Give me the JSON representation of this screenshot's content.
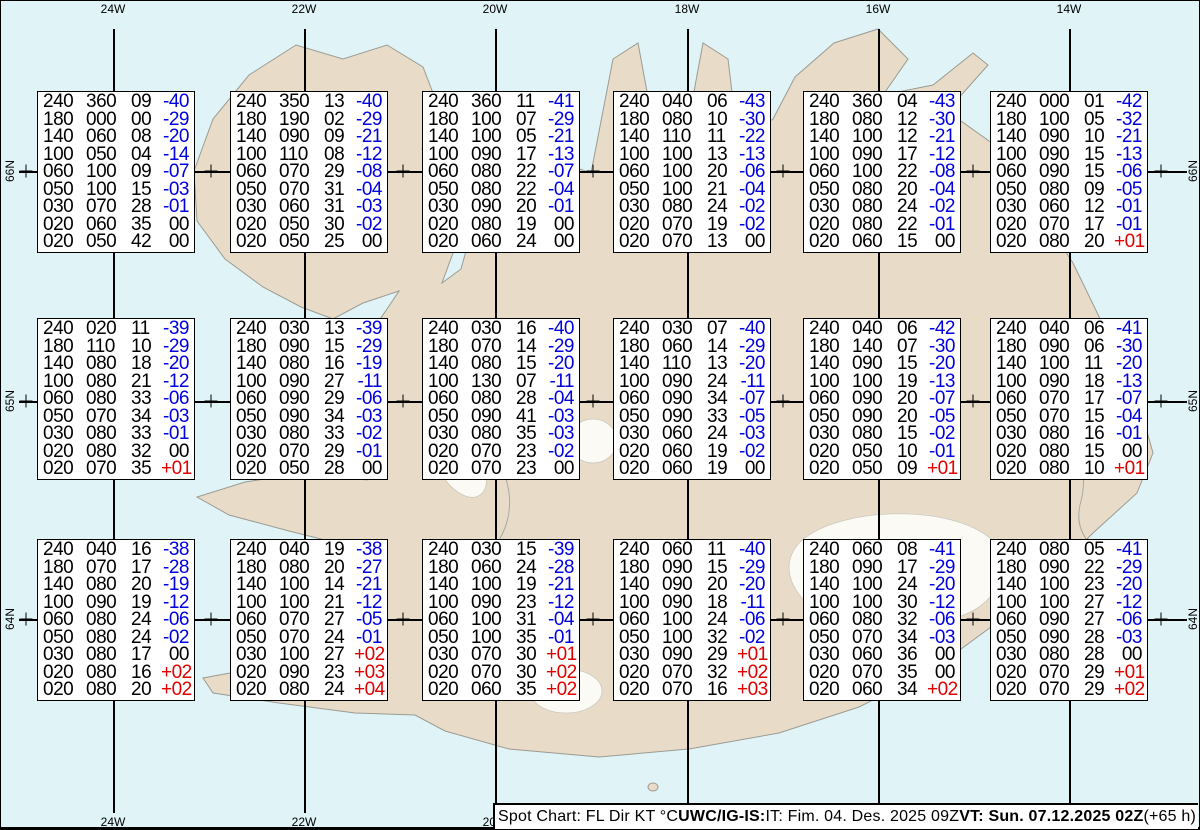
{
  "grid": {
    "meridian_labels": [
      "24W",
      "22W",
      "20W",
      "18W",
      "16W",
      "14W"
    ],
    "parallel_labels": [
      "66N",
      "65N",
      "64N"
    ]
  },
  "footer": {
    "segments": [
      {
        "text": "Spot Chart: FL Dir KT °C ",
        "bold": false
      },
      {
        "text": "UWC/IG-IS:",
        "bold": true
      },
      {
        "text": " IT: Fim. 04. Des. 2025 09Z ",
        "bold": false
      },
      {
        "text": "VT: Sun. 07.12.2025 02Z",
        "bold": true
      },
      {
        "text": " (+65 h)",
        "bold": false
      }
    ]
  },
  "colors": {
    "temp_negative": "#0000e0",
    "temp_positive": "#e00000",
    "temp_zero": "#000000",
    "values": "#000000",
    "ocean": "#e0f4f8",
    "land": "#e8dcc8"
  },
  "boxes": [
    {
      "rows": [
        [
          "240",
          "360",
          "09",
          "-40"
        ],
        [
          "180",
          "000",
          "00",
          "-29"
        ],
        [
          "140",
          "060",
          "08",
          "-20"
        ],
        [
          "100",
          "050",
          "04",
          "-14"
        ],
        [
          "060",
          "100",
          "09",
          "-07"
        ],
        [
          "050",
          "100",
          "15",
          "-03"
        ],
        [
          "030",
          "070",
          "28",
          "-01"
        ],
        [
          "020",
          "060",
          "35",
          "00"
        ],
        [
          "020",
          "050",
          "42",
          "00"
        ]
      ]
    },
    {
      "rows": [
        [
          "240",
          "350",
          "13",
          "-40"
        ],
        [
          "180",
          "190",
          "02",
          "-29"
        ],
        [
          "140",
          "090",
          "09",
          "-21"
        ],
        [
          "100",
          "110",
          "08",
          "-12"
        ],
        [
          "060",
          "070",
          "29",
          "-08"
        ],
        [
          "050",
          "070",
          "31",
          "-04"
        ],
        [
          "030",
          "060",
          "31",
          "-03"
        ],
        [
          "020",
          "050",
          "30",
          "-02"
        ],
        [
          "020",
          "050",
          "25",
          "00"
        ]
      ]
    },
    {
      "rows": [
        [
          "240",
          "360",
          "11",
          "-41"
        ],
        [
          "180",
          "100",
          "07",
          "-29"
        ],
        [
          "140",
          "100",
          "05",
          "-21"
        ],
        [
          "100",
          "090",
          "17",
          "-13"
        ],
        [
          "060",
          "080",
          "22",
          "-07"
        ],
        [
          "050",
          "080",
          "22",
          "-04"
        ],
        [
          "030",
          "090",
          "20",
          "-01"
        ],
        [
          "020",
          "080",
          "19",
          "00"
        ],
        [
          "020",
          "060",
          "24",
          "00"
        ]
      ]
    },
    {
      "rows": [
        [
          "240",
          "040",
          "06",
          "-43"
        ],
        [
          "180",
          "080",
          "10",
          "-30"
        ],
        [
          "140",
          "110",
          "11",
          "-22"
        ],
        [
          "100",
          "100",
          "13",
          "-13"
        ],
        [
          "060",
          "100",
          "20",
          "-06"
        ],
        [
          "050",
          "100",
          "21",
          "-04"
        ],
        [
          "030",
          "080",
          "24",
          "-02"
        ],
        [
          "020",
          "070",
          "19",
          "-02"
        ],
        [
          "020",
          "070",
          "13",
          "00"
        ]
      ]
    },
    {
      "rows": [
        [
          "240",
          "360",
          "04",
          "-43"
        ],
        [
          "180",
          "080",
          "12",
          "-30"
        ],
        [
          "140",
          "100",
          "12",
          "-21"
        ],
        [
          "100",
          "090",
          "17",
          "-12"
        ],
        [
          "060",
          "100",
          "22",
          "-08"
        ],
        [
          "050",
          "080",
          "20",
          "-04"
        ],
        [
          "030",
          "080",
          "24",
          "-02"
        ],
        [
          "020",
          "080",
          "22",
          "-01"
        ],
        [
          "020",
          "060",
          "15",
          "00"
        ]
      ]
    },
    {
      "rows": [
        [
          "240",
          "000",
          "01",
          "-42"
        ],
        [
          "180",
          "100",
          "05",
          "-32"
        ],
        [
          "140",
          "090",
          "10",
          "-21"
        ],
        [
          "100",
          "090",
          "15",
          "-13"
        ],
        [
          "060",
          "090",
          "15",
          "-06"
        ],
        [
          "050",
          "080",
          "09",
          "-05"
        ],
        [
          "030",
          "060",
          "12",
          "-01"
        ],
        [
          "020",
          "070",
          "17",
          "-01"
        ],
        [
          "020",
          "080",
          "20",
          "+01"
        ]
      ]
    },
    {
      "rows": [
        [
          "240",
          "020",
          "11",
          "-39"
        ],
        [
          "180",
          "110",
          "10",
          "-29"
        ],
        [
          "140",
          "080",
          "18",
          "-20"
        ],
        [
          "100",
          "080",
          "21",
          "-12"
        ],
        [
          "060",
          "080",
          "33",
          "-06"
        ],
        [
          "050",
          "070",
          "34",
          "-03"
        ],
        [
          "030",
          "080",
          "33",
          "-01"
        ],
        [
          "020",
          "080",
          "32",
          "00"
        ],
        [
          "020",
          "070",
          "35",
          "+01"
        ]
      ]
    },
    {
      "rows": [
        [
          "240",
          "030",
          "13",
          "-39"
        ],
        [
          "180",
          "090",
          "15",
          "-29"
        ],
        [
          "140",
          "080",
          "16",
          "-19"
        ],
        [
          "100",
          "090",
          "27",
          "-11"
        ],
        [
          "060",
          "090",
          "29",
          "-06"
        ],
        [
          "050",
          "090",
          "34",
          "-03"
        ],
        [
          "030",
          "080",
          "33",
          "-02"
        ],
        [
          "020",
          "070",
          "29",
          "-01"
        ],
        [
          "020",
          "050",
          "28",
          "00"
        ]
      ]
    },
    {
      "rows": [
        [
          "240",
          "030",
          "16",
          "-40"
        ],
        [
          "180",
          "070",
          "14",
          "-29"
        ],
        [
          "140",
          "080",
          "15",
          "-20"
        ],
        [
          "100",
          "130",
          "07",
          "-11"
        ],
        [
          "060",
          "080",
          "28",
          "-04"
        ],
        [
          "050",
          "090",
          "41",
          "-03"
        ],
        [
          "030",
          "080",
          "35",
          "-03"
        ],
        [
          "020",
          "070",
          "23",
          "-02"
        ],
        [
          "020",
          "070",
          "23",
          "00"
        ]
      ]
    },
    {
      "rows": [
        [
          "240",
          "030",
          "07",
          "-40"
        ],
        [
          "180",
          "060",
          "14",
          "-29"
        ],
        [
          "140",
          "110",
          "13",
          "-20"
        ],
        [
          "100",
          "090",
          "24",
          "-11"
        ],
        [
          "060",
          "090",
          "34",
          "-07"
        ],
        [
          "050",
          "090",
          "33",
          "-05"
        ],
        [
          "030",
          "060",
          "24",
          "-03"
        ],
        [
          "020",
          "060",
          "19",
          "-02"
        ],
        [
          "020",
          "060",
          "19",
          "00"
        ]
      ]
    },
    {
      "rows": [
        [
          "240",
          "040",
          "06",
          "-42"
        ],
        [
          "180",
          "140",
          "07",
          "-30"
        ],
        [
          "140",
          "090",
          "15",
          "-20"
        ],
        [
          "100",
          "100",
          "19",
          "-13"
        ],
        [
          "060",
          "090",
          "20",
          "-07"
        ],
        [
          "050",
          "090",
          "20",
          "-05"
        ],
        [
          "030",
          "080",
          "15",
          "-02"
        ],
        [
          "020",
          "050",
          "10",
          "-01"
        ],
        [
          "020",
          "050",
          "09",
          "+01"
        ]
      ]
    },
    {
      "rows": [
        [
          "240",
          "040",
          "06",
          "-41"
        ],
        [
          "180",
          "090",
          "06",
          "-30"
        ],
        [
          "140",
          "100",
          "11",
          "-20"
        ],
        [
          "100",
          "090",
          "18",
          "-13"
        ],
        [
          "060",
          "070",
          "17",
          "-07"
        ],
        [
          "050",
          "070",
          "15",
          "-04"
        ],
        [
          "030",
          "080",
          "16",
          "-01"
        ],
        [
          "020",
          "080",
          "15",
          "00"
        ],
        [
          "020",
          "080",
          "10",
          "+01"
        ]
      ]
    },
    {
      "rows": [
        [
          "240",
          "040",
          "16",
          "-38"
        ],
        [
          "180",
          "070",
          "17",
          "-28"
        ],
        [
          "140",
          "080",
          "20",
          "-19"
        ],
        [
          "100",
          "090",
          "19",
          "-12"
        ],
        [
          "060",
          "080",
          "24",
          "-06"
        ],
        [
          "050",
          "080",
          "24",
          "-02"
        ],
        [
          "030",
          "080",
          "17",
          "00"
        ],
        [
          "020",
          "080",
          "16",
          "+02"
        ],
        [
          "020",
          "080",
          "20",
          "+02"
        ]
      ]
    },
    {
      "rows": [
        [
          "240",
          "040",
          "19",
          "-38"
        ],
        [
          "180",
          "080",
          "20",
          "-27"
        ],
        [
          "140",
          "100",
          "14",
          "-21"
        ],
        [
          "100",
          "100",
          "21",
          "-12"
        ],
        [
          "060",
          "070",
          "27",
          "-05"
        ],
        [
          "050",
          "070",
          "24",
          "-01"
        ],
        [
          "030",
          "100",
          "27",
          "+02"
        ],
        [
          "020",
          "090",
          "23",
          "+03"
        ],
        [
          "020",
          "080",
          "24",
          "+04"
        ]
      ]
    },
    {
      "rows": [
        [
          "240",
          "030",
          "15",
          "-39"
        ],
        [
          "180",
          "060",
          "24",
          "-28"
        ],
        [
          "140",
          "100",
          "19",
          "-21"
        ],
        [
          "100",
          "090",
          "23",
          "-12"
        ],
        [
          "060",
          "100",
          "31",
          "-04"
        ],
        [
          "050",
          "100",
          "35",
          "-01"
        ],
        [
          "030",
          "070",
          "30",
          "+01"
        ],
        [
          "020",
          "070",
          "30",
          "+02"
        ],
        [
          "020",
          "060",
          "35",
          "+02"
        ]
      ]
    },
    {
      "rows": [
        [
          "240",
          "060",
          "11",
          "-40"
        ],
        [
          "180",
          "090",
          "15",
          "-29"
        ],
        [
          "140",
          "090",
          "20",
          "-20"
        ],
        [
          "100",
          "090",
          "18",
          "-11"
        ],
        [
          "060",
          "100",
          "24",
          "-06"
        ],
        [
          "050",
          "100",
          "32",
          "-02"
        ],
        [
          "030",
          "090",
          "29",
          "+01"
        ],
        [
          "020",
          "070",
          "32",
          "+02"
        ],
        [
          "020",
          "070",
          "16",
          "+03"
        ]
      ]
    },
    {
      "rows": [
        [
          "240",
          "060",
          "08",
          "-41"
        ],
        [
          "180",
          "090",
          "17",
          "-29"
        ],
        [
          "140",
          "100",
          "24",
          "-20"
        ],
        [
          "100",
          "100",
          "30",
          "-12"
        ],
        [
          "060",
          "080",
          "32",
          "-06"
        ],
        [
          "050",
          "070",
          "34",
          "-03"
        ],
        [
          "030",
          "060",
          "36",
          "00"
        ],
        [
          "020",
          "070",
          "35",
          "00"
        ],
        [
          "020",
          "060",
          "34",
          "+02"
        ]
      ]
    },
    {
      "rows": [
        [
          "240",
          "080",
          "05",
          "-41"
        ],
        [
          "180",
          "090",
          "22",
          "-29"
        ],
        [
          "140",
          "100",
          "23",
          "-20"
        ],
        [
          "100",
          "100",
          "27",
          "-12"
        ],
        [
          "060",
          "090",
          "27",
          "-06"
        ],
        [
          "050",
          "090",
          "28",
          "-03"
        ],
        [
          "030",
          "080",
          "28",
          "00"
        ],
        [
          "020",
          "070",
          "29",
          "+01"
        ],
        [
          "020",
          "070",
          "29",
          "+02"
        ]
      ]
    }
  ]
}
